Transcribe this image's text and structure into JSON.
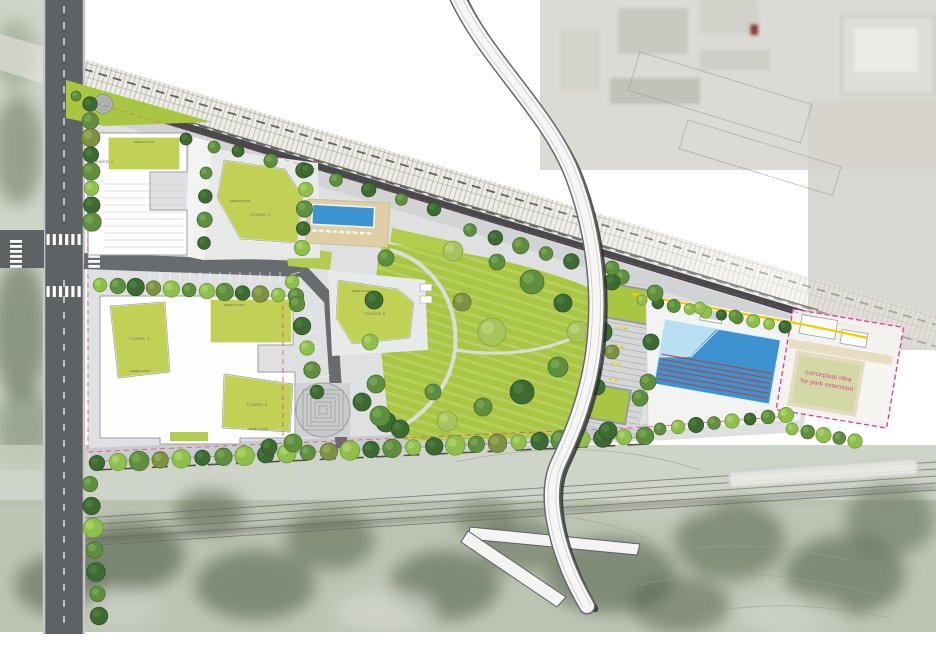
{
  "labels": {
    "tower_1": "TOWER 1",
    "tower_2": "TOWER 2",
    "tower_3": "TOWER 3",
    "tower_4": "TOWER 4",
    "tower_5": "TOWER 5",
    "green_roof": "GREEN ROOF",
    "extension_note_line1": "conceptual idea",
    "extension_note_line2": "for park extension"
  },
  "colors": {
    "roof_green": "#c0d156",
    "lawn_green": "#a9c642",
    "pool_blue": "#3d93cf",
    "pool_shallow": "#b8e0f2",
    "lane_red": "#c23b2e",
    "accent_magenta": "#e23a8e",
    "highlight_yellow": "#f2ce00",
    "road_gray": "#5f6264",
    "promenade_dark": "#47494b",
    "paving_light": "#dfe0e1",
    "rail_base": "#eceae4",
    "tree_dark": "#3c6a32",
    "tree_mid": "#5f8f3e",
    "tree_bright": "#8fbf4c",
    "tree_olive": "#7d9140",
    "tree_light": "#a7c45c"
  }
}
